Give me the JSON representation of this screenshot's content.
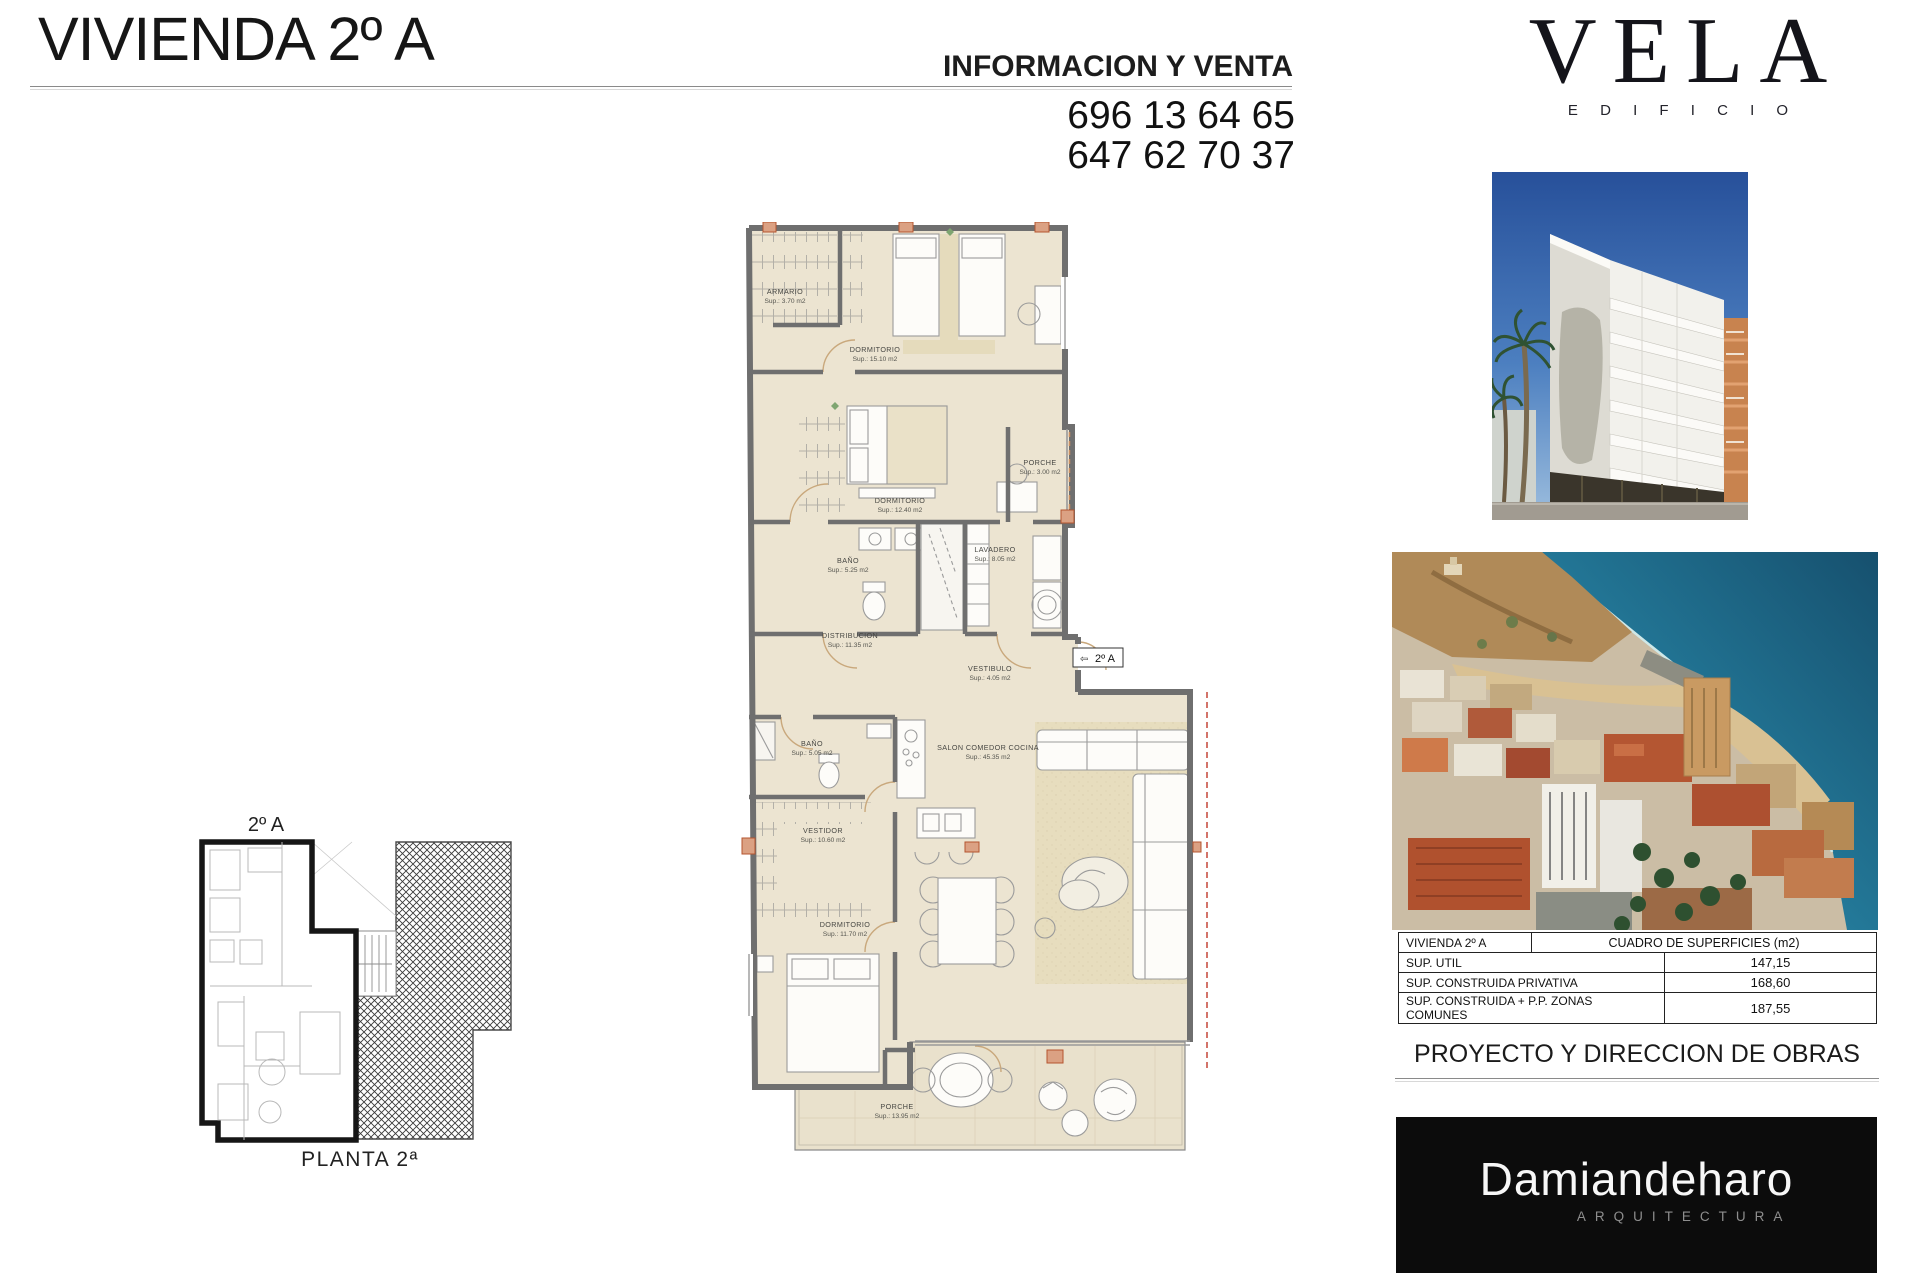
{
  "header": {
    "title": "VIVIENDA 2º A",
    "info_label": "INFORMACION Y VENTA",
    "phones": [
      "696 13 64 65",
      "647 62 70 37"
    ],
    "logo": {
      "name": "VELA",
      "subtitle": "E D I F I C I O"
    }
  },
  "plan": {
    "unit_tag": "2º A",
    "unit_tag_arrow": "⇦",
    "rooms": [
      {
        "label": "ARMARIO",
        "sup": "Sup.: 3.70 m2"
      },
      {
        "label": "DORMITORIO",
        "sup": "Sup.: 15.10 m2"
      },
      {
        "label": "DORMITORIO",
        "sup": "Sup.: 12.40 m2"
      },
      {
        "label": "PORCHE",
        "sup": "Sup.: 3.00 m2"
      },
      {
        "label": "BAÑO",
        "sup": "Sup.: 5.25 m2"
      },
      {
        "label": "LAVADERO",
        "sup": "Sup.: 8.05 m2"
      },
      {
        "label": "DISTRIBUCION",
        "sup": "Sup.: 11.35 m2"
      },
      {
        "label": "VESTIBULO",
        "sup": "Sup.: 4.05 m2"
      },
      {
        "label": "SALON COMEDOR COCINA",
        "sup": "Sup.: 45.35 m2"
      },
      {
        "label": "BAÑO",
        "sup": "Sup.: 5.05 m2"
      },
      {
        "label": "VESTIDOR",
        "sup": "Sup.: 10.60 m2"
      },
      {
        "label": "DORMITORIO",
        "sup": "Sup.: 11.70 m2"
      },
      {
        "label": "PORCHE",
        "sup": "Sup.: 13.95 m2"
      }
    ]
  },
  "key_plan": {
    "unit_label": "2º A",
    "caption": "PLANTA 2ª"
  },
  "surfaces_table": {
    "unit": "VIVIENDA 2º A",
    "title": "CUADRO DE SUPERFICIES (m2)",
    "rows": [
      {
        "label": "SUP. UTIL",
        "value": "147,15"
      },
      {
        "label": "SUP. CONSTRUIDA PRIVATIVA",
        "value": "168,60"
      },
      {
        "label": "SUP. CONSTRUIDA + P.P. ZONAS COMUNES",
        "value": "187,55"
      }
    ]
  },
  "project": {
    "heading": "PROYECTO Y DIRECCION DE OBRAS"
  },
  "architect": {
    "name": "Damiandeharo",
    "subtitle": "ARQUITECTURA"
  },
  "colors": {
    "floor": "#ece4d1",
    "wall": "#6f6f6f",
    "accent_orange": "#d29a78",
    "hatch": "#3a3a3a",
    "brand_bg": "#0c0c0c",
    "sea": "#1b6283",
    "sky": "#2a57a0"
  }
}
